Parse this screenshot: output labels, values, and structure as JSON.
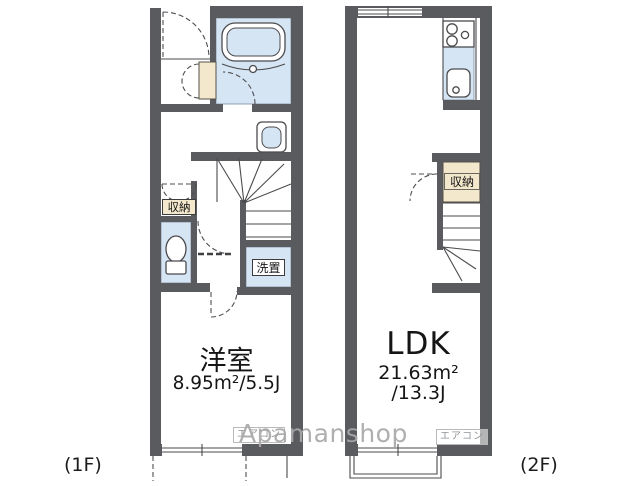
{
  "watermark": "Apamanshop",
  "colors": {
    "wall": "#5a5b5f",
    "wet": "#d5e5f4",
    "storage": "#f4e8cc",
    "line": "#4b4b4e",
    "muted": "#8f9398"
  },
  "floor1": {
    "floor_label": "(1F)",
    "room": {
      "name": "洋室",
      "area": "8.95m²/5.5J"
    },
    "storage_label": "収納",
    "laundry_label": "洗置",
    "aircon_label": "エアコン"
  },
  "floor2": {
    "floor_label": "(2F)",
    "room": {
      "name": "LDK",
      "area_m2": "21.63m²",
      "area_j": "/13.3J"
    },
    "storage_label": "収納",
    "aircon_label": "エアコン"
  }
}
